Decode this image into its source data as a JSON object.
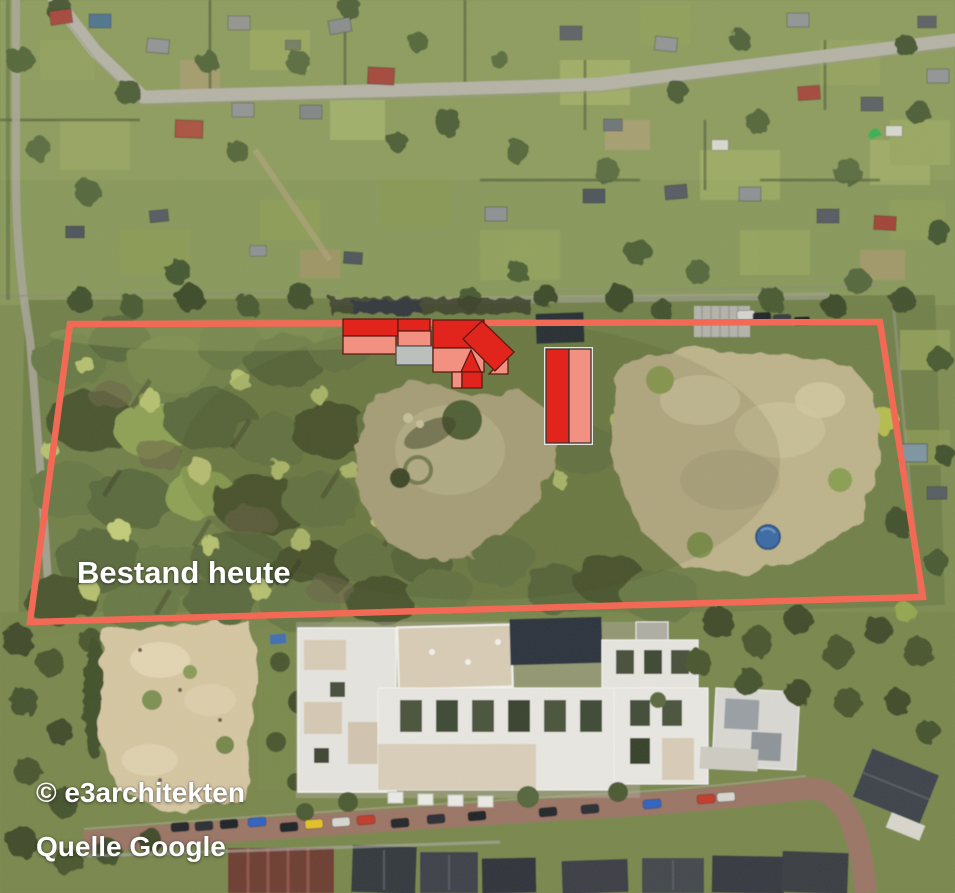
{
  "annotations": {
    "site_label": "Bestand heute",
    "copyright": "© e3architekten",
    "source": "Quelle Google"
  },
  "overlay": {
    "colors": {
      "boundary": "#f26a55",
      "red": "#e2251c",
      "salmon": "#f29082",
      "gray": "#bcc0bc",
      "white_edge": "#e9e9e3"
    },
    "strokes": {
      "default": "#5a1b12",
      "gray": "#55554f",
      "dark": "#33332f",
      "none": "none"
    },
    "site_boundary": {
      "points": [
        [
          70,
          324
        ],
        [
          880,
          322
        ],
        [
          923,
          597
        ],
        [
          30,
          622
        ]
      ],
      "stroke_width": 6.5
    },
    "buildings": [
      {
        "id": "west-wing-north",
        "fill": "red",
        "points": [
          [
            343,
            319
          ],
          [
            398,
            319
          ],
          [
            398,
            336
          ],
          [
            343,
            336
          ]
        ]
      },
      {
        "id": "west-wing-south",
        "fill": "salmon",
        "points": [
          [
            343,
            336
          ],
          [
            396,
            336
          ],
          [
            396,
            354
          ],
          [
            343,
            354
          ]
        ]
      },
      {
        "id": "mid-block-north",
        "fill": "red",
        "points": [
          [
            398,
            319
          ],
          [
            430,
            319
          ],
          [
            430,
            331
          ],
          [
            398,
            331
          ]
        ]
      },
      {
        "id": "mid-block-center",
        "fill": "salmon",
        "points": [
          [
            398,
            331
          ],
          [
            431,
            331
          ],
          [
            431,
            346
          ],
          [
            398,
            346
          ]
        ]
      },
      {
        "id": "mid-annex",
        "fill": "gray",
        "stroke": "gray",
        "points": [
          [
            396,
            346
          ],
          [
            433,
            346
          ],
          [
            433,
            365
          ],
          [
            396,
            365
          ]
        ]
      },
      {
        "id": "main-house-north",
        "fill": "red",
        "points": [
          [
            433,
            320
          ],
          [
            484,
            320
          ],
          [
            484,
            348
          ],
          [
            433,
            348
          ]
        ]
      },
      {
        "id": "main-house-south",
        "fill": "salmon",
        "points": [
          [
            433,
            348
          ],
          [
            484,
            348
          ],
          [
            484,
            372
          ],
          [
            433,
            372
          ]
        ]
      },
      {
        "id": "main-house-gable",
        "fill": "red",
        "points": [
          [
            471,
            350
          ],
          [
            461,
            372
          ],
          [
            481,
            372
          ]
        ]
      },
      {
        "id": "south-annex-left",
        "fill": "salmon",
        "points": [
          [
            452,
            372
          ],
          [
            462,
            372
          ],
          [
            462,
            388
          ],
          [
            452,
            388
          ]
        ]
      },
      {
        "id": "south-annex-right",
        "fill": "red",
        "points": [
          [
            462,
            372
          ],
          [
            482,
            372
          ],
          [
            482,
            388
          ],
          [
            462,
            388
          ]
        ]
      },
      {
        "id": "diagonal-wing-south",
        "fill": "salmon",
        "points": [
          [
            489,
            374
          ],
          [
            508,
            355
          ],
          [
            508,
            374
          ]
        ]
      },
      {
        "id": "diagonal-wing",
        "fill": "red",
        "points": [
          [
            482,
            321
          ],
          [
            514,
            352
          ],
          [
            495,
            371
          ],
          [
            463,
            339
          ]
        ]
      },
      {
        "id": "east-hall-base",
        "fill": "white_edge",
        "stroke": "none",
        "points": [
          [
            544,
            347
          ],
          [
            593,
            347
          ],
          [
            593,
            445
          ],
          [
            544,
            445
          ]
        ]
      },
      {
        "id": "east-hall-west",
        "fill": "red",
        "stroke": "dark",
        "points": [
          [
            546,
            349
          ],
          [
            569,
            349
          ],
          [
            569,
            443
          ],
          [
            546,
            443
          ]
        ]
      },
      {
        "id": "east-hall-east",
        "fill": "salmon",
        "stroke": "dark",
        "points": [
          [
            569,
            349
          ],
          [
            591,
            349
          ],
          [
            591,
            443
          ],
          [
            569,
            443
          ]
        ]
      }
    ]
  }
}
